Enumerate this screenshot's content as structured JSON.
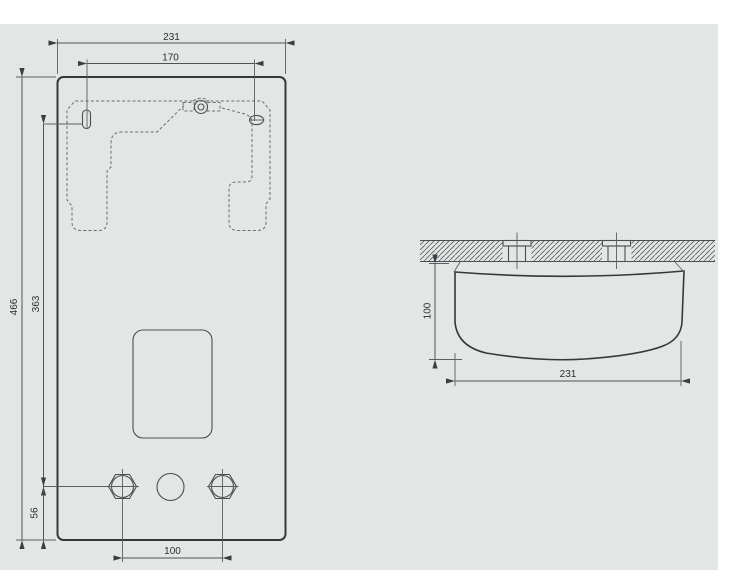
{
  "drawing": {
    "front_view": {
      "dim_overall_width": "231",
      "dim_mount_hole_spacing": "170",
      "dim_overall_height": "466",
      "dim_mount_to_connections": "363",
      "dim_connections_to_bottom": "56",
      "dim_connection_spacing": "100"
    },
    "side_view": {
      "dim_depth": "100",
      "dim_overall_width": "231"
    },
    "colors": {
      "panel_background": "#e2e7e5",
      "main_outline": "#34383b",
      "dimension_lines": "#4e5356",
      "dashed_bracket": "#686d70"
    }
  }
}
